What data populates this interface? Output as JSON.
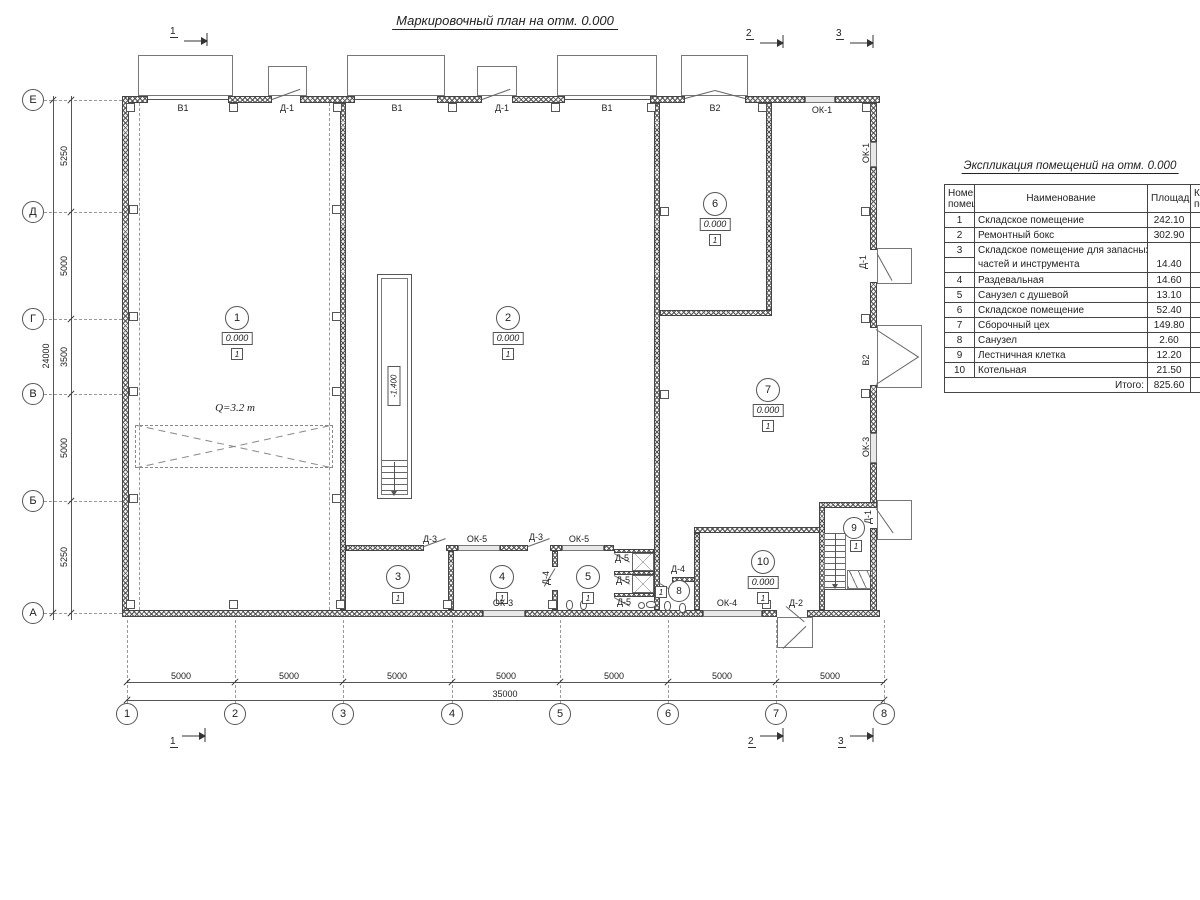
{
  "title": "Маркировочный план на отм. 0.000",
  "sections": {
    "one": "1",
    "two": "2",
    "three": "3"
  },
  "axes": {
    "rows": [
      "Е",
      "Д",
      "Г",
      "В",
      "Б",
      "А"
    ],
    "cols": [
      "1",
      "2",
      "3",
      "4",
      "5",
      "6",
      "7",
      "8"
    ]
  },
  "dims": {
    "left_segments": [
      "5250",
      "5000",
      "3500",
      "5000",
      "5250"
    ],
    "left_total": "24000",
    "bottom_segments": [
      "5000",
      "5000",
      "5000",
      "5000",
      "5000",
      "5000",
      "5000"
    ],
    "bottom_total": "35000"
  },
  "labels": {
    "v1": "В1",
    "v2": "В2",
    "d1": "Д-1",
    "d2": "Д-2",
    "d3": "Д-3",
    "d4": "Д-4",
    "d5": "Д-5",
    "ok1": "ОК-1",
    "ok3": "ОК-3",
    "ok4": "ОК-4",
    "ok5": "ОК-5",
    "crane_load": "Q=3.2 т",
    "pit_depth": "-1.400"
  },
  "rooms": {
    "r1": {
      "num": "1",
      "elev": "0.000",
      "floor": "1"
    },
    "r2": {
      "num": "2",
      "elev": "0.000",
      "floor": "1"
    },
    "r3": {
      "num": "3",
      "floor": "1"
    },
    "r4": {
      "num": "4",
      "floor": "1"
    },
    "r5": {
      "num": "5",
      "floor": "1"
    },
    "r6": {
      "num": "6",
      "elev": "0.000",
      "floor": "1"
    },
    "r7": {
      "num": "7",
      "elev": "0.000",
      "floor": "1"
    },
    "r8": {
      "num": "8",
      "floor": "1"
    },
    "r9": {
      "num": "9",
      "floor": "1"
    },
    "r10": {
      "num": "10",
      "elev": "0.000",
      "floor": "1"
    }
  },
  "table": {
    "title": "Экспликация помещений на отм. 0.000",
    "headers": {
      "num_line1": "Номер",
      "num_line2": "помещ.",
      "name": "Наименование",
      "area": "Площадь",
      "cat_line1": "Ка",
      "cat_line2": "по"
    },
    "rows": [
      {
        "num": "1",
        "name": "Складское помещение",
        "area": "242.10"
      },
      {
        "num": "2",
        "name": "Ремонтный бокс",
        "area": "302.90"
      },
      {
        "num": "3",
        "name": "Складское помещение для запасных",
        "area": ""
      },
      {
        "num": "",
        "name": "частей и инструмента",
        "area": "14.40"
      },
      {
        "num": "4",
        "name": "Раздевальная",
        "area": "14.60"
      },
      {
        "num": "5",
        "name": "Санузел с душевой",
        "area": "13.10"
      },
      {
        "num": "6",
        "name": "Складское помещение",
        "area": "52.40"
      },
      {
        "num": "7",
        "name": "Сборочный цех",
        "area": "149.80"
      },
      {
        "num": "8",
        "name": "Санузел",
        "area": "2.60"
      },
      {
        "num": "9",
        "name": "Лестничная клетка",
        "area": "12.20"
      },
      {
        "num": "10",
        "name": "Котельная",
        "area": "21.50"
      }
    ],
    "total_label": "Итого:",
    "total": "825.60"
  }
}
